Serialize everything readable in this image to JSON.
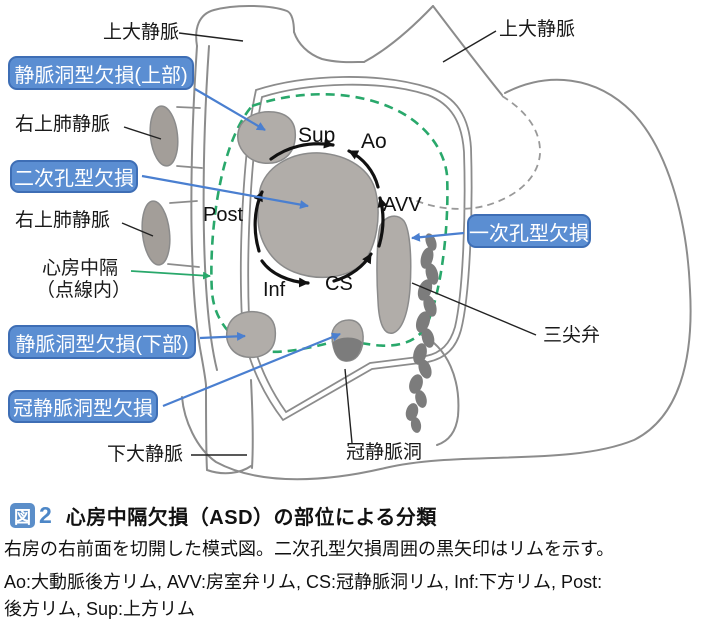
{
  "figure": {
    "vessel_labels": {
      "svc_left": "上大静脈",
      "svc_right": "上大静脈",
      "rupv_upper": "右上肺静脈",
      "rupv_lower": "右上肺静脈",
      "septum_line1": "心房中隔",
      "septum_line2": "（点線内）",
      "ivc": "下大静脈",
      "coronary_sinus": "冠静脈洞",
      "tricuspid_valve": "三尖弁"
    },
    "defect_boxes": {
      "sinus_venosus_upper": "静脈洞型欠損(上部)",
      "secundum": "二次孔型欠損",
      "sinus_venosus_lower": "静脈洞型欠損(下部)",
      "coronary_sinus_defect": "冠静脈洞型欠損",
      "primum": "一次孔型欠損"
    },
    "rim_labels": {
      "sup": "Sup",
      "ao": "Ao",
      "avv": "AVV",
      "post": "Post",
      "inf": "Inf",
      "cs": "CS"
    }
  },
  "caption": {
    "badge": "図",
    "number": "2",
    "title": "心房中隔欠損（ASD）の部位による分類",
    "note": "右房の右前面を切開した模式図。二次孔型欠損周囲の黒矢印はリムを示す。",
    "abbrev_line1": "Ao:大動脈後方リム, AVV:房室弁リム, CS:冠静脈洞リム, Inf:下方リム, Post:",
    "abbrev_line2": "後方リム, Sup:上方リム"
  },
  "colors": {
    "label_box_blue": "#5b8ed2",
    "label_box_border": "#3e6eb5",
    "arrow_blue": "#4a7fd0",
    "septum_green": "#29a86b",
    "outline_gray": "#8c8c8c",
    "defect_fill": "#b1ada9",
    "dark_gray": "#7c7c7c",
    "badge_blue": "#5b8ec9",
    "fig_number_blue": "#4d87c7"
  }
}
